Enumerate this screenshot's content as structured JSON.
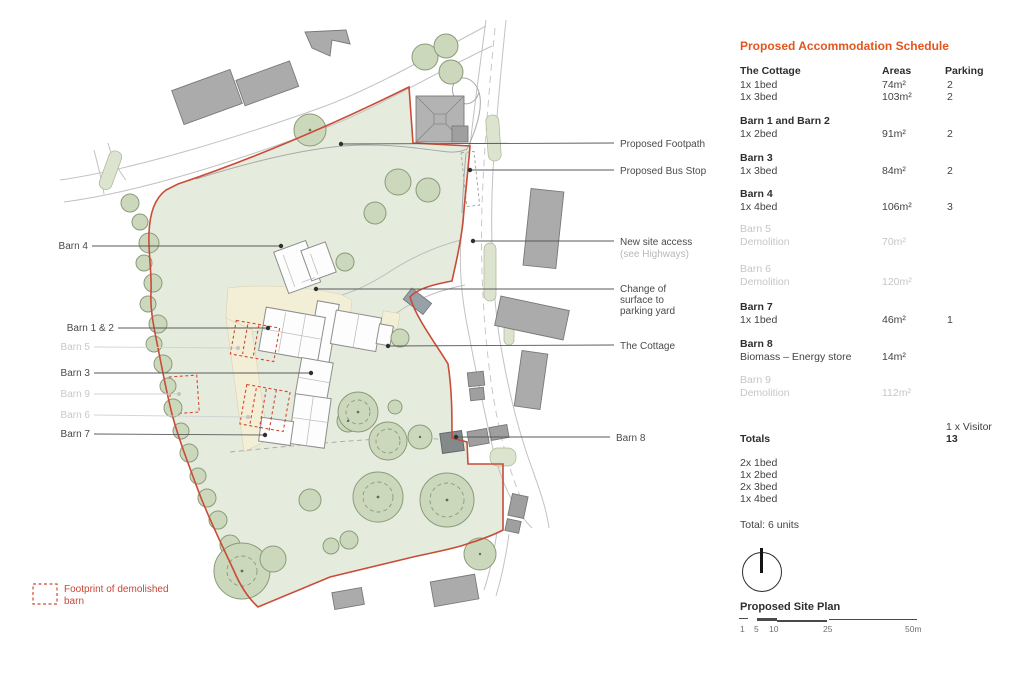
{
  "colors": {
    "accent_orange": "#e2561e",
    "boundary_red": "#c94b38",
    "site_green": "#e6ecdd",
    "tree_green": "#ccd8bb",
    "demolished_grey": "#c6c6c6",
    "text_dark": "#3e3e3e"
  },
  "schedule": {
    "title": "Proposed Accommodation Schedule",
    "col_areas": "Areas",
    "col_parking": "Parking",
    "groups": [
      {
        "name": "The Cottage",
        "rows": [
          {
            "desc": "1x 1bed",
            "area": "74m²",
            "parking": "2"
          },
          {
            "desc": "1x 3bed",
            "area": "103m²",
            "parking": "2"
          }
        ]
      },
      {
        "name": "Barn 1 and Barn 2",
        "rows": [
          {
            "desc": "1x 2bed",
            "area": "91m²",
            "parking": "2"
          }
        ]
      },
      {
        "name": "Barn 3",
        "rows": [
          {
            "desc": "1x 3bed",
            "area": "84m²",
            "parking": "2"
          }
        ]
      },
      {
        "name": "Barn 4",
        "rows": [
          {
            "desc": "1x 4bed",
            "area": "106m²",
            "parking": "3"
          }
        ]
      },
      {
        "name": "Barn 5",
        "demolished": true,
        "rows": [
          {
            "desc": "Demolition",
            "area": "70m²",
            "parking": ""
          }
        ]
      },
      {
        "name": "Barn 6",
        "demolished": true,
        "rows": [
          {
            "desc": "Demolition",
            "area": "120m²",
            "parking": ""
          }
        ]
      },
      {
        "name": "Barn 7",
        "rows": [
          {
            "desc": "1x 1bed",
            "area": "46m²",
            "parking": "1"
          }
        ]
      },
      {
        "name": "Barn 8",
        "rows": [
          {
            "desc": "Biomass – Energy store",
            "area": "14m²",
            "parking": ""
          }
        ]
      },
      {
        "name": "Barn 9",
        "demolished": true,
        "rows": [
          {
            "desc": "Demolition",
            "area": "112m²",
            "parking": ""
          }
        ]
      }
    ],
    "totals": {
      "visitor": "1 x Visitor",
      "label": "Totals",
      "parking_total": "13",
      "breakdown": [
        "2x 1bed",
        "1x 2bed",
        "2x 3bed",
        "1x 4bed"
      ],
      "units": "Total: 6 units"
    }
  },
  "plan": {
    "title": "Proposed Site Plan",
    "scale_labels": [
      "1",
      "5",
      "10",
      "25",
      "50m"
    ],
    "legend": {
      "label_line1": "Footprint of demolished",
      "label_line2": "barn"
    },
    "labels": {
      "barn4": "Barn 4",
      "barn12": "Barn 1 & 2",
      "barn5": "Barn 5",
      "barn3": "Barn 3",
      "barn9": "Barn 9",
      "barn6": "Barn 6",
      "barn7": "Barn 7",
      "footpath": "Proposed Footpath",
      "bus_stop": "Proposed Bus Stop",
      "access1": "New site access",
      "access2": "(see Highways)",
      "surface1": "Change of",
      "surface2": "surface to",
      "surface3": "parking yard",
      "cottage": "The Cottage",
      "barn8": "Barn 8"
    }
  }
}
